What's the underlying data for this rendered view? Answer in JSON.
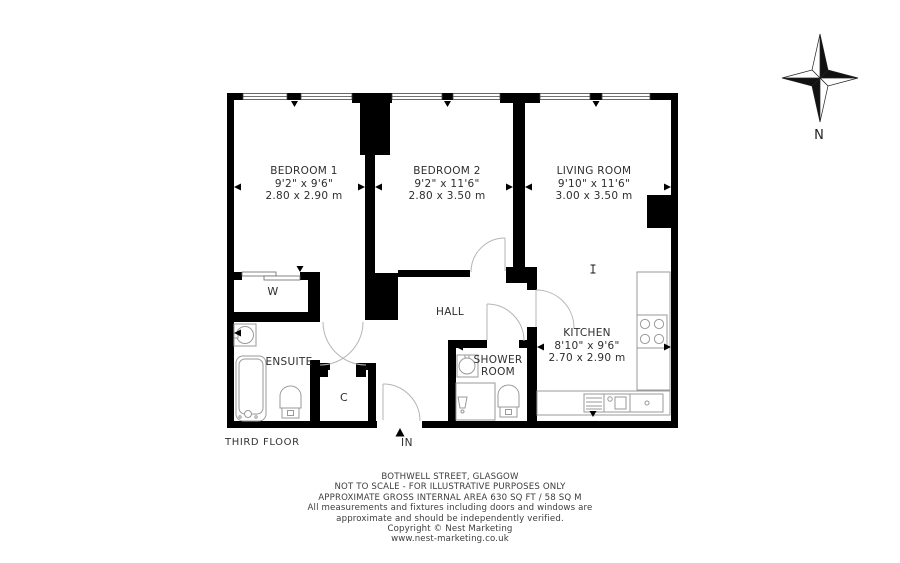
{
  "plan": {
    "floor_label": "THIRD FLOOR",
    "entrance_label": "IN",
    "compass_label": "N",
    "rooms": [
      {
        "name": "BEDROOM 1",
        "imperial": "9'2\" x 9'6\"",
        "metric": "2.80 x 2.90 m"
      },
      {
        "name": "BEDROOM 2",
        "imperial": "9'2\" x 11'6\"",
        "metric": "2.80 x 3.50 m"
      },
      {
        "name": "LIVING ROOM",
        "imperial": "9'10\" x 11'6\"",
        "metric": "3.00 x 3.50 m"
      },
      {
        "name": "KITCHEN",
        "imperial": "8'10\" x 9'6\"",
        "metric": "2.70 x 2.90 m"
      },
      {
        "name": "HALL"
      },
      {
        "name": "ENSUITE"
      },
      {
        "name": "SHOWER ROOM"
      },
      {
        "name": "W"
      },
      {
        "name": "C"
      }
    ]
  },
  "footer": {
    "address": "BOTHWELL STREET, GLASGOW",
    "scale_note": "NOT TO SCALE - FOR ILLUSTRATIVE PURPOSES ONLY",
    "area_note": "APPROXIMATE GROSS INTERNAL AREA 630 SQ FT / 58 SQ M",
    "disclaimer_line1": "All measurements and fixtures including doors and windows are",
    "disclaimer_line2": "approximate and should be independently verified.",
    "copyright": "Copyright © Nest Marketing",
    "website": "www.nest-marketing.co.uk"
  },
  "colors": {
    "wall": "#000000",
    "fixture_line": "#9a9a9a",
    "door_arc": "#b5b5b5",
    "text": "#2e2e2e"
  }
}
